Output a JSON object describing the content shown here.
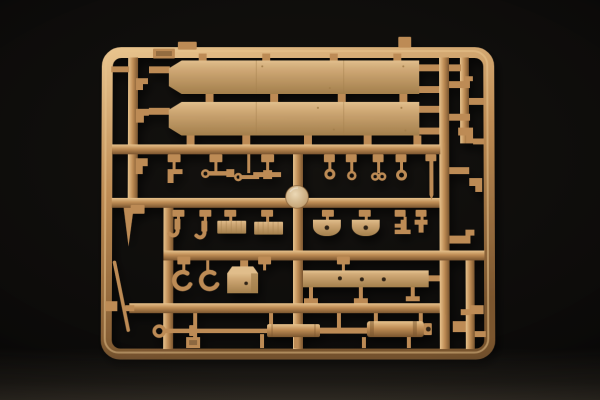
{
  "scene": {
    "type": "product-photo",
    "subject": "model-kit-sprue",
    "description": "Tan injection-molded plastic model kit sprue (parts frame) photographed on a black studio background; rectangular runner frame filled with fender panels, hooks, clamps, axle housings, a stowage box, a skirt strip and a long multi-section barrel shaft",
    "background": "black studio backdrop with soft reflection at the bottom",
    "sprue_contents": [
      "upper fender panel",
      "lower fender panel",
      "round dome disc",
      "tow hooks x2",
      "ribbed grille plates x2",
      "round axle housings x2",
      "eye bolts and rings",
      "tie rods and linkages",
      "C-shaped clamps x2",
      "stowage box",
      "hull skirt strip with three holes",
      "long multi-section shaft with eyelet and end cap",
      "thin tapered rod",
      "assorted small brackets, pins and fittings",
      "molded part-number tags"
    ]
  },
  "colors": {
    "bg": "#0b0a09",
    "bg-low": "#2a2520",
    "plastic": "#bd8b54",
    "plastic-hi": "#e7c28c",
    "plastic-lo": "#7a552e",
    "panel": "#cda673",
    "panel-hi": "#e0bd8b",
    "panel-lo": "#a37f4c",
    "disc-hi": "#ecd9b6",
    "disc-lo": "#bb9766",
    "hole": "#2e2212"
  }
}
